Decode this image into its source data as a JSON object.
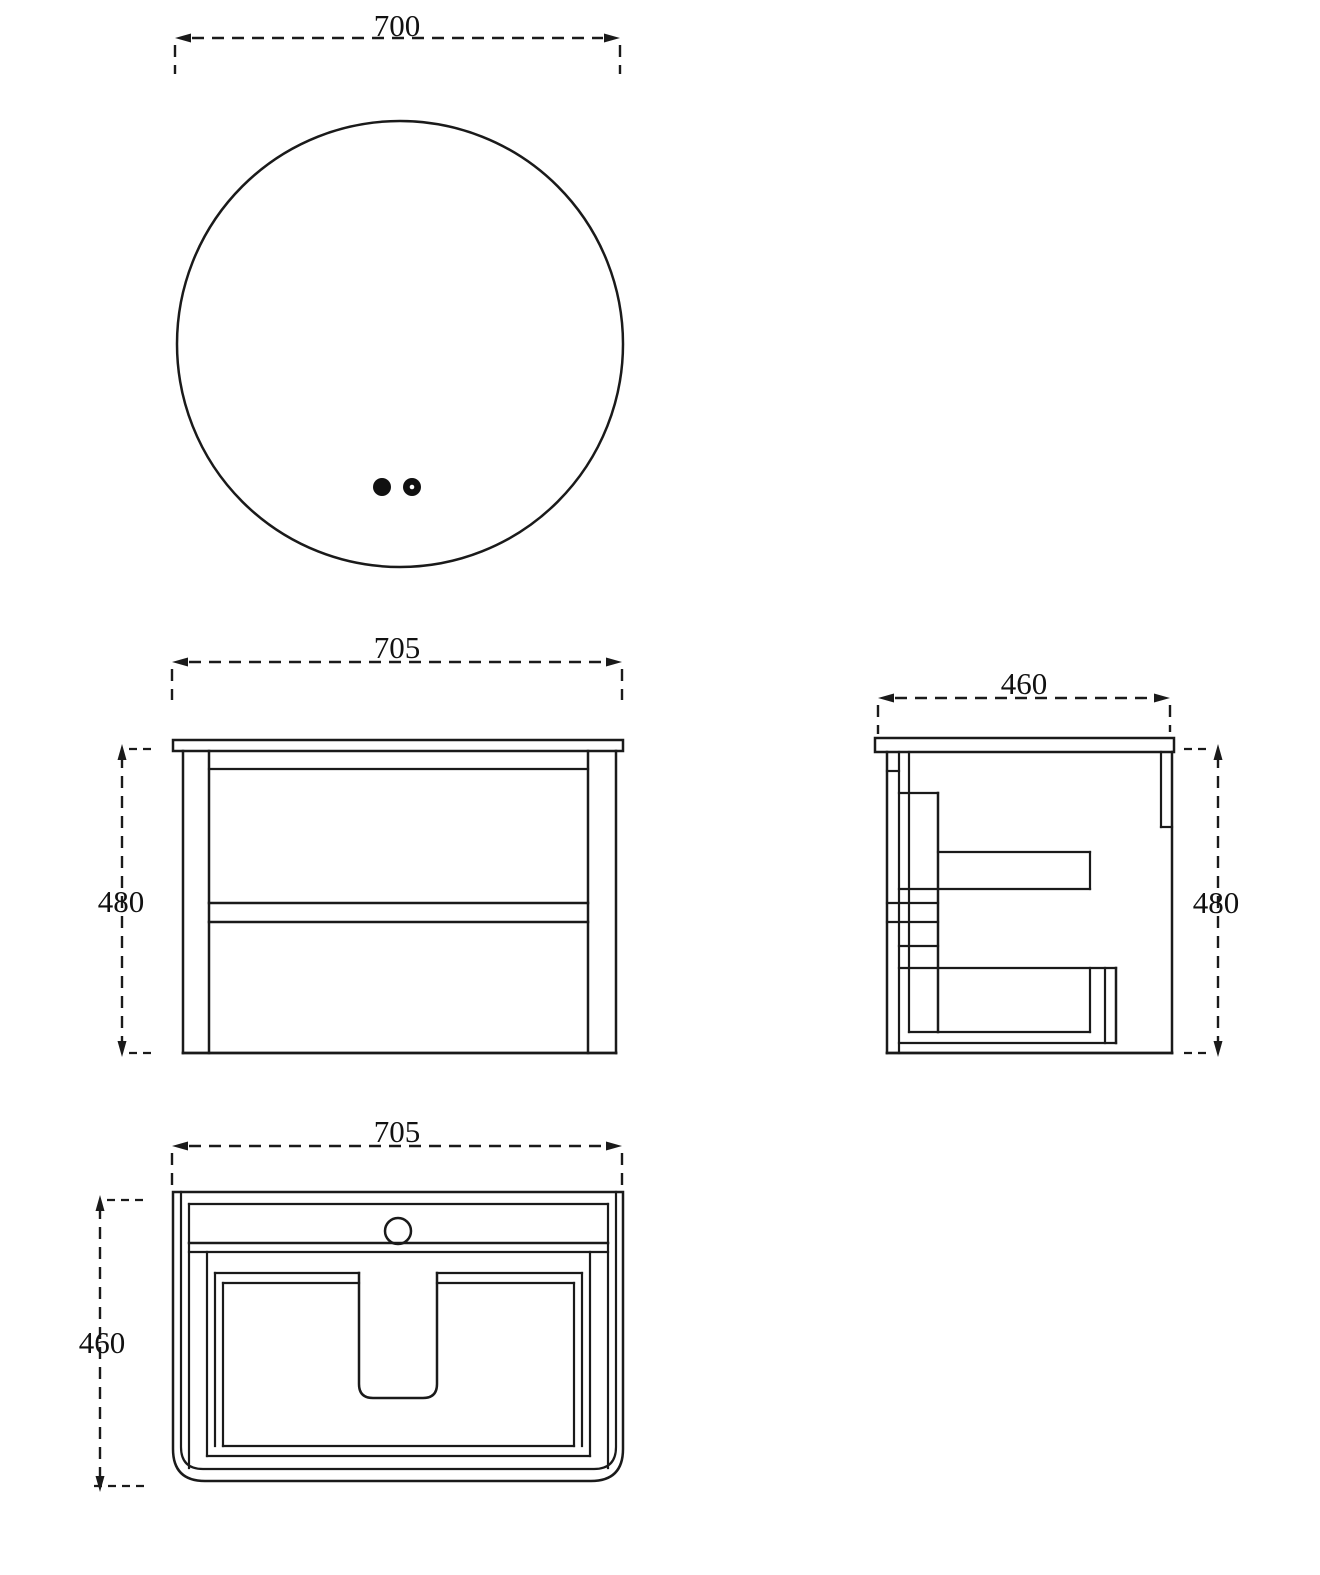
{
  "drawing_type": "technical-dimension-drawing",
  "colors": {
    "line": "#1a1a1a",
    "background": "#ffffff"
  },
  "views": {
    "mirror_top": {
      "description": "round mirror front view with two sensor dots",
      "width_dim": "700"
    },
    "front": {
      "description": "cabinet front view with two drawers",
      "width_dim": "705",
      "height_dim": "480"
    },
    "side": {
      "description": "cabinet side section view",
      "depth_dim": "460",
      "height_dim": "480"
    },
    "bottom": {
      "description": "cabinet bottom view with basin cutout and faucet hole",
      "width_dim": "705",
      "depth_dim": "460"
    }
  }
}
